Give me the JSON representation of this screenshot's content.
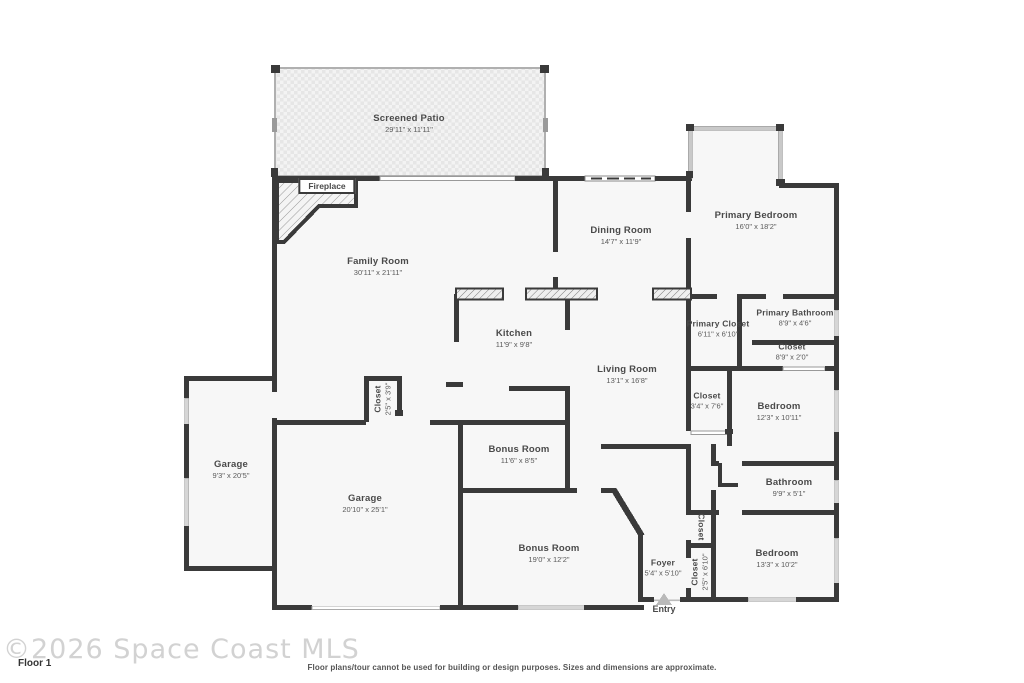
{
  "page": {
    "watermark": "©2026 Space Coast MLS",
    "floor_label": "Floor 1",
    "disclaimer": "Floor plans/tour cannot be used for building or design purposes. Sizes and dimensions are approximate.",
    "entry_label": "Entry"
  },
  "colors": {
    "wall": "#3a3a3a",
    "room_fill": "#f7f7f7",
    "window": "#d6d6d6",
    "bay_window": "#c9c9c9",
    "label_text": "#4a4a4a"
  },
  "rooms": [
    {
      "id": "screened-patio",
      "name": "Screened Patio",
      "dims": "29'11\" x 11'11\""
    },
    {
      "id": "fireplace",
      "name": "Fireplace",
      "dims": ""
    },
    {
      "id": "family-room",
      "name": "Family Room",
      "dims": "30'11\" x 21'11\""
    },
    {
      "id": "dining-room",
      "name": "Dining Room",
      "dims": "14'7\" x 11'9\""
    },
    {
      "id": "primary-bedroom",
      "name": "Primary Bedroom",
      "dims": "16'0\" x 18'2\""
    },
    {
      "id": "kitchen",
      "name": "Kitchen",
      "dims": "11'9\" x 9'8\""
    },
    {
      "id": "primary-closet",
      "name": "Primary Closet",
      "dims": "6'11\" x 6'10\""
    },
    {
      "id": "primary-bathroom",
      "name": "Primary Bathroom",
      "dims": "8'9\" x 4'6\""
    },
    {
      "id": "closet-hall",
      "name": "Closet",
      "dims": "8'9\" x 2'0\""
    },
    {
      "id": "living-room",
      "name": "Living Room",
      "dims": "13'1\" x 16'8\""
    },
    {
      "id": "closet-bedroom2",
      "name": "Closet",
      "dims": "3'4\" x 7'6\""
    },
    {
      "id": "bedroom2",
      "name": "Bedroom",
      "dims": "12'3\" x 10'11\""
    },
    {
      "id": "garage-small",
      "name": "Garage",
      "dims": "9'3\" x 20'5\""
    },
    {
      "id": "closet-garage",
      "name": "Closet",
      "dims": "2'5\" x 3'9\""
    },
    {
      "id": "garage-main",
      "name": "Garage",
      "dims": "20'10\" x 25'1\""
    },
    {
      "id": "bonus-room-small",
      "name": "Bonus Room",
      "dims": "11'6\" x 8'5\""
    },
    {
      "id": "bonus-room-large",
      "name": "Bonus Room",
      "dims": "19'0\" x 12'2\""
    },
    {
      "id": "foyer",
      "name": "Foyer",
      "dims": "5'4\" x 5'10\""
    },
    {
      "id": "closet-foyer-upper",
      "name": "Closet",
      "dims": ""
    },
    {
      "id": "closet-foyer-lower",
      "name": "Closet",
      "dims": "2'5\" x 6'10\""
    },
    {
      "id": "bathroom",
      "name": "Bathroom",
      "dims": "9'9\" x 5'1\""
    },
    {
      "id": "bedroom3",
      "name": "Bedroom",
      "dims": "13'3\" x 10'2\""
    }
  ]
}
